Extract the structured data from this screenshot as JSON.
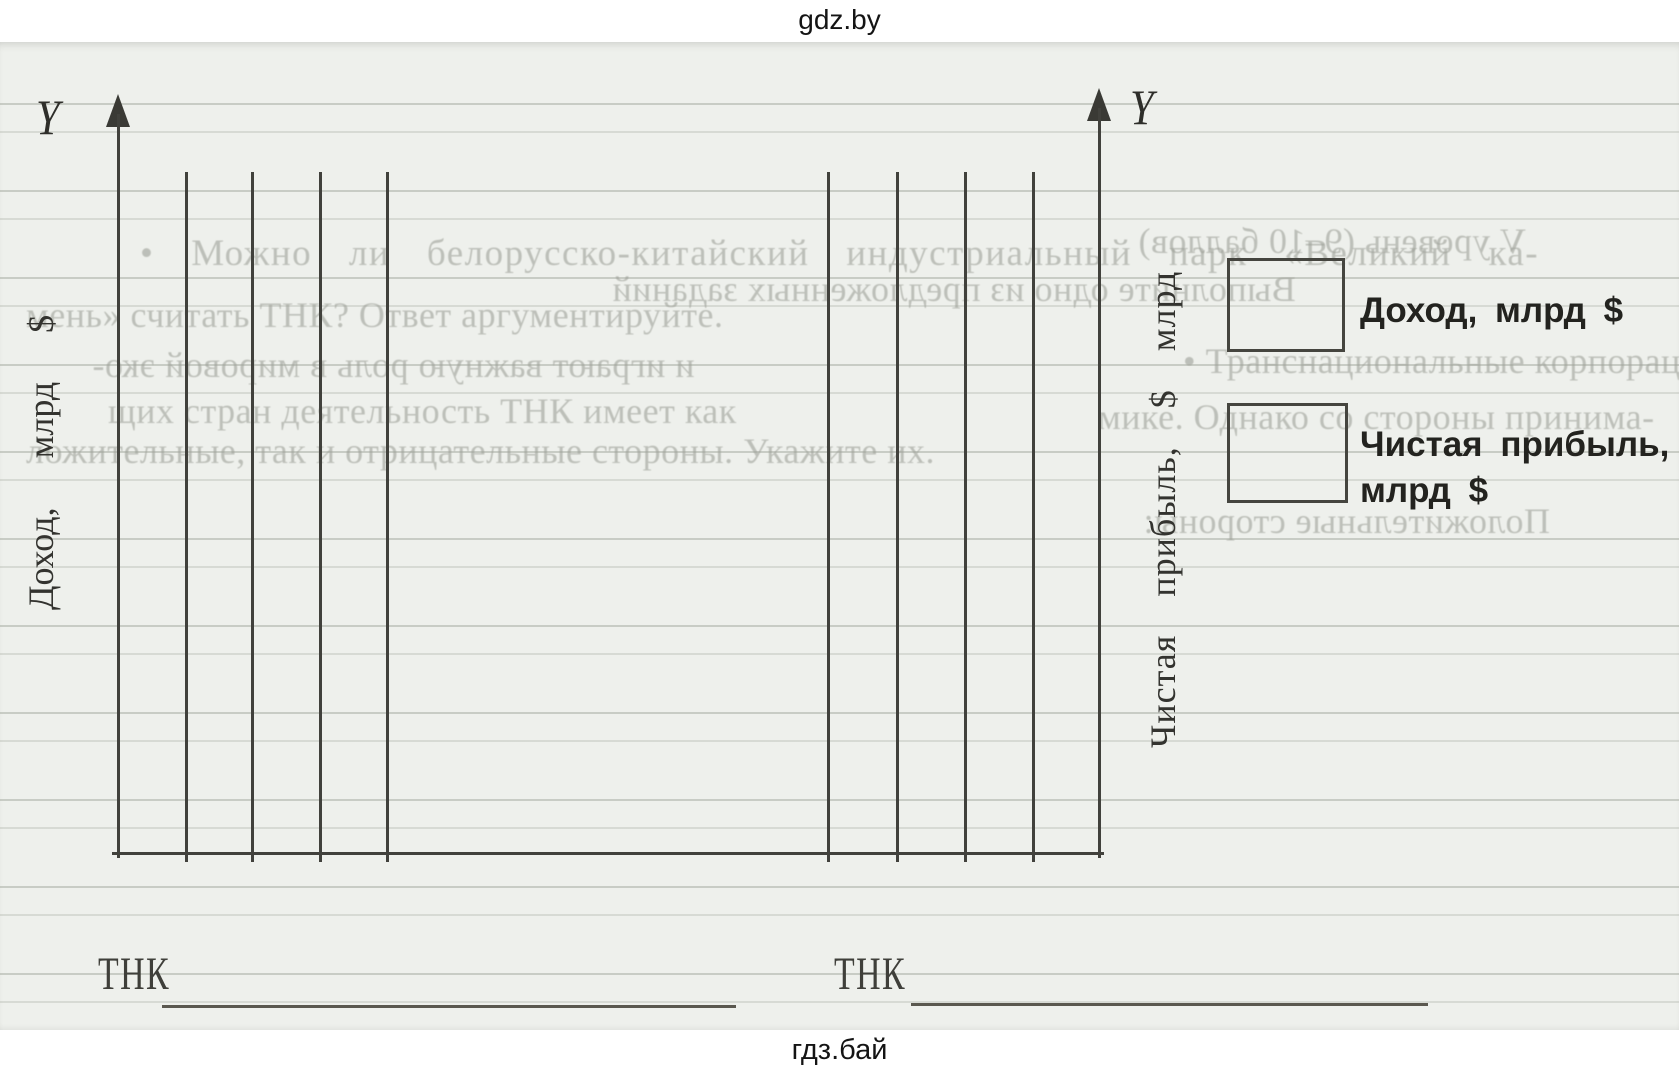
{
  "watermarks": {
    "top": "gdz.by",
    "bottom": "гдз.бай"
  },
  "chart_data": [
    {
      "type": "bar",
      "state": "blank_template",
      "title": "",
      "axis_letter": "Y",
      "ylabel": "Доход, млрд $",
      "xlabel": "ТНК",
      "bar_slots": 4,
      "categories": [],
      "values": [],
      "grid": "ruled paper only",
      "legend_position": "right"
    },
    {
      "type": "bar",
      "state": "blank_template",
      "title": "",
      "axis_letter": "Y",
      "ylabel": "Чистая прибыль, $ млрд",
      "xlabel": "ТНК",
      "bar_slots": 4,
      "categories": [],
      "values": [],
      "grid": "ruled paper only",
      "legend_position": "right"
    }
  ],
  "legend": {
    "items": [
      {
        "label": "Доход, млрд $"
      },
      {
        "label_line1": "Чистая прибыль,",
        "label_line2": "млрд $"
      }
    ]
  },
  "ghost_text": [
    {
      "text": "• Можно ли белорусско-китайский индустриальный парк «Великий ка-",
      "mirrored": false,
      "x": 140,
      "y": 190,
      "wide": true
    },
    {
      "text": "мень» считать ТНК? Ответ аргументируйте.",
      "mirrored": false,
      "x": 26,
      "y": 252,
      "wide": false
    },
    {
      "text": "V уровень (9–10 баллов)",
      "mirrored": true,
      "x": 1138,
      "y": 178,
      "wide": false
    },
    {
      "text": "Выполните одно из предложенных заданий",
      "mirrored": true,
      "x": 612,
      "y": 226,
      "wide": false
    },
    {
      "text": "и играют важную роль в мировой эко-",
      "mirrored": true,
      "x": 92,
      "y": 302,
      "wide": false
    },
    {
      "text": "• Транснациональные корпорации",
      "mirrored": false,
      "x": 1183,
      "y": 298,
      "wide": false
    },
    {
      "text": "щих стран деятельность ТНК имеет как",
      "mirrored": false,
      "x": 108,
      "y": 348,
      "wide": false
    },
    {
      "text": "мике. Однако со стороны принима-",
      "mirrored": false,
      "x": 1098,
      "y": 354,
      "wide": false
    },
    {
      "text": "ложительные, так и отрицательные стороны.  Укажите их.",
      "mirrored": false,
      "x": 26,
      "y": 388,
      "wide": false
    },
    {
      "text": "Положительные стороны:",
      "mirrored": true,
      "x": 1143,
      "y": 458,
      "wide": false
    }
  ]
}
